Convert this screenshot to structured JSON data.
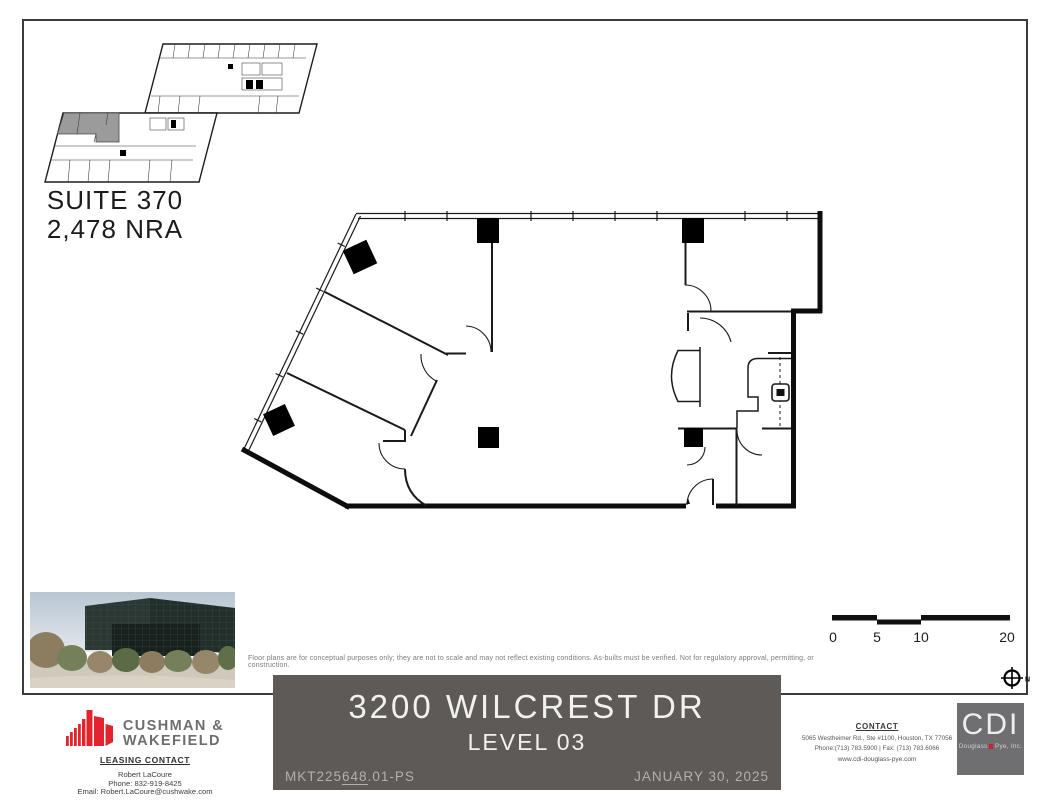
{
  "key_plan": {
    "suite_label": "SUITE 370",
    "area_label": "2,478 NRA",
    "highlight_color": "#9b9b9b"
  },
  "disclaimer": "Floor plans are for conceptual purposes only; they are not to scale and may not reflect existing conditions. As-builts must be verified. Not for regulatory approval, permitting, or construction.",
  "scale_bar": {
    "labels": [
      "0",
      "5",
      "10",
      "20"
    ]
  },
  "north": {
    "label": "N"
  },
  "title_block": {
    "address": "3200 WILCREST DR",
    "level": "LEVEL 03",
    "doc_prefix": "MKT225",
    "doc_mid": "648",
    "doc_suffix": ".01-PS",
    "date": "JANUARY 30, 2025",
    "bg_color": "#5e5a57"
  },
  "leasing": {
    "brand_line1": "CUSHMAN &",
    "brand_line2": "WAKEFIELD",
    "brand_red": "#e2242e",
    "heading": "LEASING CONTACT",
    "name": "Robert LaCoure",
    "phone": "Phone: 832-919-8425",
    "email": "Email: Robert.LaCoure@cushwake.com"
  },
  "cdi": {
    "heading": "CONTACT",
    "address": "5065 Westheimer Rd., Ste #1100, Houston, TX 77056",
    "phone_fax": "Phone:(713) 783.5900   |   Fax: (713) 783.6066",
    "website": "www.cdi-douglass-pye.com",
    "logo_text": "CDI",
    "logo_sub_left": "Douglass",
    "logo_sub_right": "Pye, Inc.",
    "logo_bg": "#6f6f71",
    "accent_red": "#cf2030"
  }
}
